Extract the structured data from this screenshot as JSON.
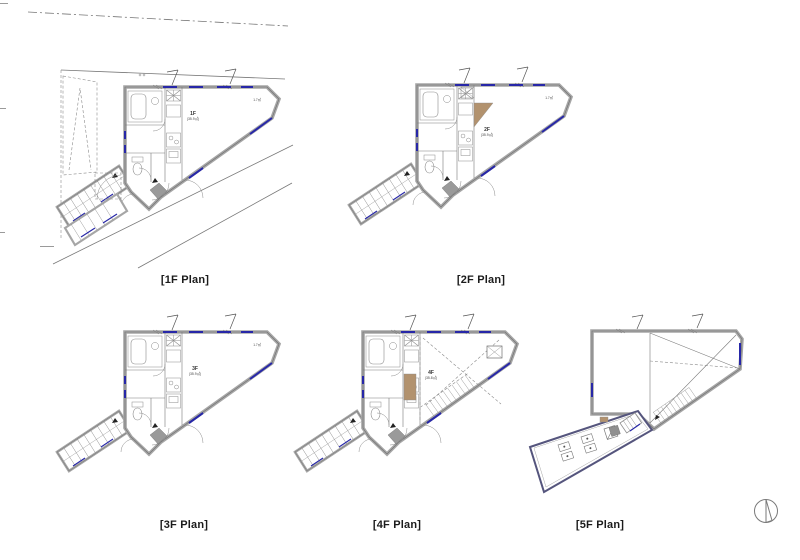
{
  "sheet": {
    "background": "#ffffff"
  },
  "plans": [
    {
      "id": "1f",
      "label": "[1F Plan]",
      "room_label": "1F",
      "room_area": "(35.9㎡)",
      "corner_note": "1.7㎡"
    },
    {
      "id": "2f",
      "label": "[2F Plan]",
      "room_label": "2F",
      "room_area": "(35.9㎡)",
      "corner_note": "1.7㎡"
    },
    {
      "id": "3f",
      "label": "[3F Plan]",
      "room_label": "3F",
      "room_area": "(35.9㎡)",
      "corner_note": "1.7㎡"
    },
    {
      "id": "4f",
      "label": "[4F Plan]",
      "room_label": "4F",
      "room_area": "(35.8㎡)"
    },
    {
      "id": "5f",
      "label": "[5F Plan]"
    }
  ],
  "colors": {
    "wall_fill": "#ffffff",
    "wall_stroke": "#a6a6a6",
    "wall_edge": "#6e6e6e",
    "window_blue": "#2727a8",
    "wood_tan": "#b2926e",
    "terrace_border": "#55557d",
    "step_gray": "#8f8f8f",
    "site_line": "#777777"
  },
  "icons": {
    "compass": "north-arrow"
  }
}
